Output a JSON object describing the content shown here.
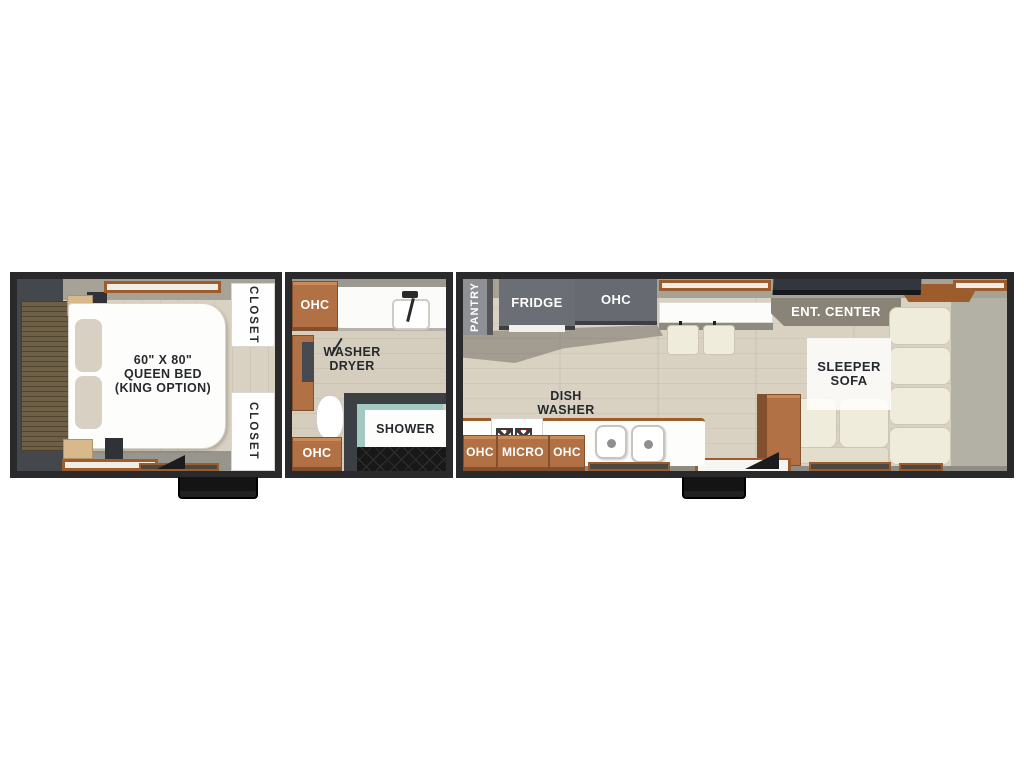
{
  "title": "RV travel trailer floor plan",
  "bedroom": {
    "bed_label_line1": "60\" X 80\"",
    "bed_label_line2": "QUEEN BED",
    "bed_label_line3": "(KING OPTION)",
    "closet_top": "CLOSET",
    "closet_bottom": "CLOSET"
  },
  "bathroom": {
    "ohc_top": "OHC",
    "washer_dryer_line1": "WASHER",
    "washer_dryer_line2": "DRYER",
    "shower": "SHOWER",
    "ohc_bottom": "OHC"
  },
  "kitchen_living": {
    "pantry": "PANTRY",
    "fridge": "FRIDGE",
    "ohc_top": "OHC",
    "dish_washer_line1": "DISH",
    "dish_washer_line2": "WASHER",
    "ohc_left": "OHC",
    "micro": "MICRO",
    "ohc_right": "OHC",
    "ent_center": "ENT. CENTER",
    "sleeper_sofa_line1": "SLEEPER",
    "sleeper_sofa_line2": "SOFA"
  },
  "colors": {
    "wall-dark": "#2a2a2c",
    "wall-mid": "#44474c",
    "wall-band": "#a7a296",
    "floor-light": "#d9d2c2",
    "floor-bath": "#d5cebe",
    "floor-gray": "#b3b1a6",
    "cabinet-brown": "#b17144",
    "cabinet-brown-dark": "#82502c",
    "cabinet-brown-light": "#c98a58",
    "wood-trim": "#9c5c2c",
    "cabinet-gray": "#6b6e74",
    "pantry-gray": "#8e9094",
    "sofa-cream": "#efecdb",
    "sofa-cream-dark": "#e2decb",
    "glass-teal": "#a3c9c3",
    "tv-dark": "#33363c",
    "label-dark": "#26292d",
    "pillow": "#d8d1c3",
    "headboard": "#6e6046"
  }
}
